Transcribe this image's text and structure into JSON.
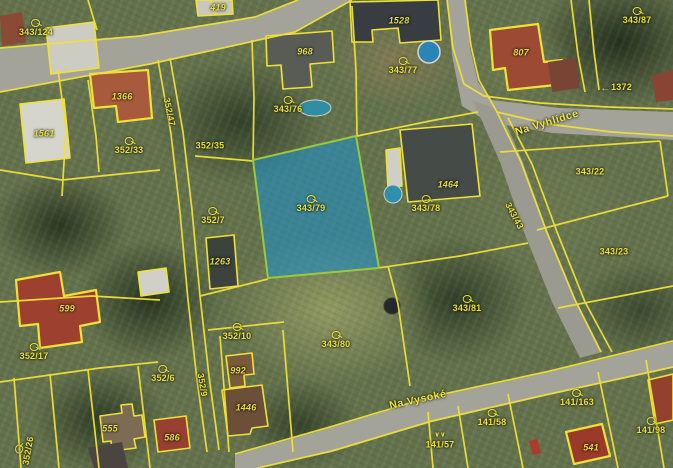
{
  "map": {
    "type": "cadastral-map-over-orthophoto",
    "selected_parcel": "343/79",
    "colors": {
      "parcel_line": "#f0e138",
      "label": "#ebe23a",
      "highlight_fill": "#1e90c8",
      "highlight_border": "#9cc83c",
      "road": "#a3a399"
    },
    "streets": [
      {
        "name": "Na Vyhlídce"
      },
      {
        "name": "Na Vysoké"
      }
    ],
    "labels": [
      {
        "text": "343/124",
        "x": 36,
        "y": 28,
        "kind": "parcel",
        "icon": "key"
      },
      {
        "text": "419",
        "x": 218,
        "y": 8,
        "kind": "building"
      },
      {
        "text": "968",
        "x": 305,
        "y": 52,
        "kind": "building"
      },
      {
        "text": "1528",
        "x": 399,
        "y": 21,
        "kind": "building"
      },
      {
        "text": "343/76",
        "x": 288,
        "y": 105,
        "kind": "parcel",
        "icon": "key"
      },
      {
        "text": "343/77",
        "x": 403,
        "y": 66,
        "kind": "parcel",
        "icon": "key"
      },
      {
        "text": "807",
        "x": 521,
        "y": 53,
        "kind": "building"
      },
      {
        "text": "343/87",
        "x": 637,
        "y": 16,
        "kind": "parcel",
        "icon": "key"
      },
      {
        "text": "1372",
        "x": 616,
        "y": 87,
        "kind": "parcel-plain",
        "icon": "arrow-left"
      },
      {
        "text": "Na Vyhlídce",
        "x": 547,
        "y": 123,
        "kind": "street",
        "rot": -17
      },
      {
        "text": "1561",
        "x": 44,
        "y": 134,
        "kind": "building"
      },
      {
        "text": "1366",
        "x": 122,
        "y": 97,
        "kind": "building"
      },
      {
        "text": "352/33",
        "x": 129,
        "y": 146,
        "kind": "parcel",
        "icon": "key"
      },
      {
        "text": "352/35",
        "x": 210,
        "y": 146,
        "kind": "parcel-plain"
      },
      {
        "text": "352/47",
        "x": 169,
        "y": 112,
        "kind": "parcel-plain",
        "rot": 78
      },
      {
        "text": "343/79",
        "x": 311,
        "y": 204,
        "kind": "parcel",
        "icon": "key"
      },
      {
        "text": "343/78",
        "x": 426,
        "y": 204,
        "kind": "parcel",
        "icon": "key"
      },
      {
        "text": "1464",
        "x": 448,
        "y": 185,
        "kind": "building"
      },
      {
        "text": "343/43",
        "x": 514,
        "y": 216,
        "kind": "parcel-plain",
        "rot": 62
      },
      {
        "text": "343/22",
        "x": 590,
        "y": 172,
        "kind": "parcel-plain"
      },
      {
        "text": "343/23",
        "x": 614,
        "y": 252,
        "kind": "parcel-plain"
      },
      {
        "text": "352/7",
        "x": 213,
        "y": 216,
        "kind": "parcel",
        "icon": "key"
      },
      {
        "text": "1263",
        "x": 220,
        "y": 262,
        "kind": "building"
      },
      {
        "text": "599",
        "x": 67,
        "y": 309,
        "kind": "building"
      },
      {
        "text": "352/17",
        "x": 34,
        "y": 352,
        "kind": "parcel",
        "icon": "key"
      },
      {
        "text": "352/6",
        "x": 163,
        "y": 374,
        "kind": "parcel",
        "icon": "key"
      },
      {
        "text": "352/10",
        "x": 237,
        "y": 332,
        "kind": "parcel",
        "icon": "key"
      },
      {
        "text": "352/9",
        "x": 202,
        "y": 385,
        "kind": "parcel-plain",
        "rot": 80
      },
      {
        "text": "992",
        "x": 238,
        "y": 371,
        "kind": "building"
      },
      {
        "text": "1446",
        "x": 246,
        "y": 408,
        "kind": "building"
      },
      {
        "text": "343/80",
        "x": 336,
        "y": 340,
        "kind": "parcel",
        "icon": "key"
      },
      {
        "text": "343/81",
        "x": 467,
        "y": 304,
        "kind": "parcel",
        "icon": "key"
      },
      {
        "text": "352/26",
        "x": 24,
        "y": 450,
        "kind": "parcel",
        "icon": "key",
        "rot": -80
      },
      {
        "text": "555",
        "x": 110,
        "y": 429,
        "kind": "building"
      },
      {
        "text": "586",
        "x": 172,
        "y": 438,
        "kind": "building"
      },
      {
        "text": "Na Vysoké",
        "x": 418,
        "y": 400,
        "kind": "street",
        "rot": -12
      },
      {
        "text": "141/57",
        "x": 440,
        "y": 437,
        "kind": "parcel",
        "icon": "scrub"
      },
      {
        "text": "141/58",
        "x": 492,
        "y": 418,
        "kind": "parcel",
        "icon": "key"
      },
      {
        "text": "141/163",
        "x": 577,
        "y": 398,
        "kind": "parcel",
        "icon": "key"
      },
      {
        "text": "141/98",
        "x": 651,
        "y": 426,
        "kind": "parcel",
        "icon": "key"
      },
      {
        "text": "541",
        "x": 591,
        "y": 448,
        "kind": "building"
      }
    ]
  }
}
